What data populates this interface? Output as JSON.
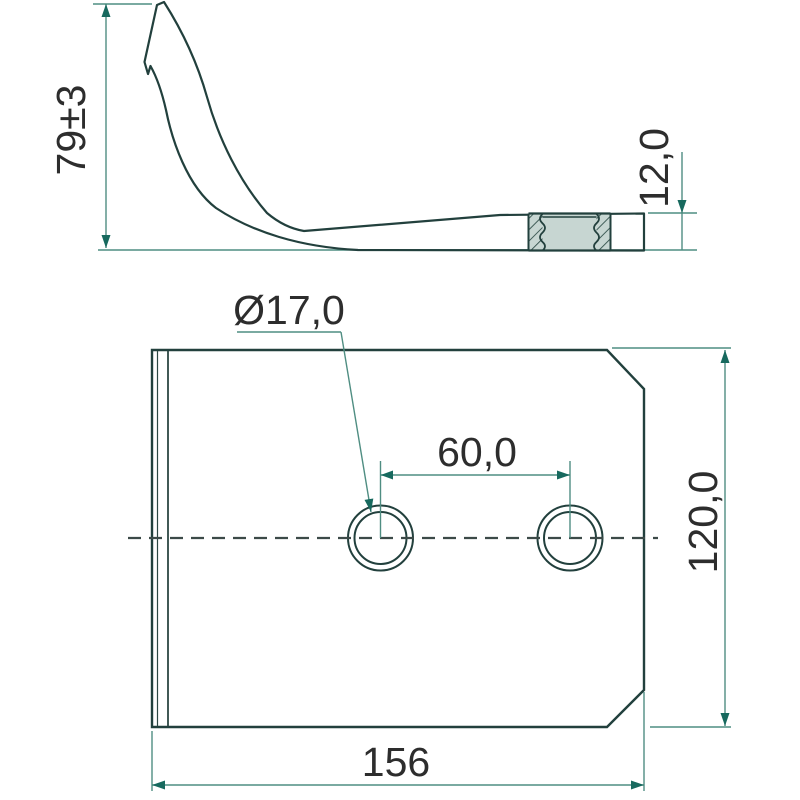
{
  "drawing": {
    "type": "technical-2-view-drawing",
    "colors": {
      "part_fill": "#86a9a5",
      "part_outline": "#22403d",
      "hole_ring": "#c3d2ce",
      "hole_inner": "#cfdbd7",
      "nut_section_fill": "#c7d6d2",
      "dimension_line": "#4f8d82",
      "dimension_arrow": "#17695e",
      "centerline": "#3c4a48",
      "text": "#2d2d2d",
      "background": "#ffffff"
    },
    "side_view": {
      "description_dims": {
        "height": "79±3",
        "thickness": "12,0"
      }
    },
    "plan_view": {
      "description_dims": {
        "hole_diameter": "Ø17,0",
        "hole_spacing": "60,0",
        "plate_height": "120,0",
        "plate_width": "156"
      }
    }
  }
}
